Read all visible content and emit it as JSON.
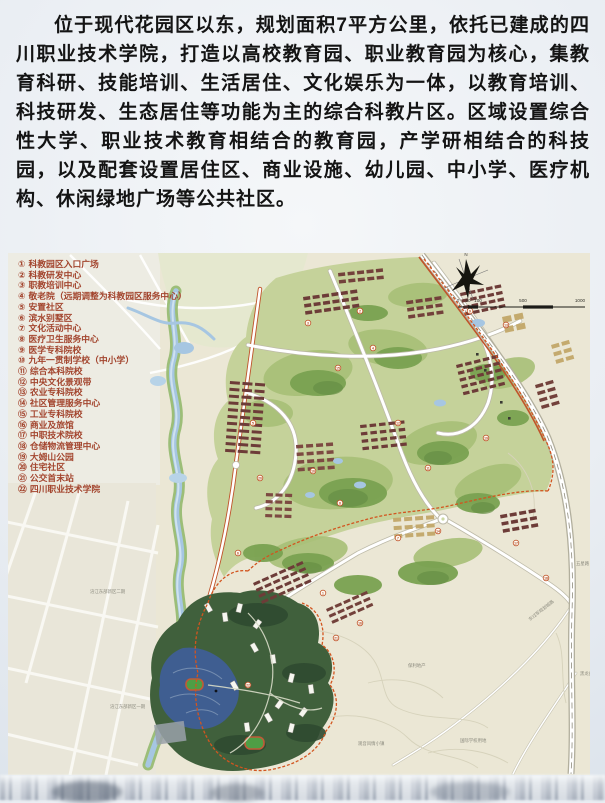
{
  "intro": {
    "text": "位于现代花园区以东，规划面积7平方公里，依托已建成的四川职业技术学院，打造以高校教育园、职业教育园为核心，集教育科研、技能培训、生活居住、文化娱乐为一体，以教育培训、科技研发、生态居住等功能为主的综合科教片区。区域设置综合性大学、职业技术教育相结合的教育园，产学研相结合的科技园，以及配套设置居住区、商业设施、幼儿园、中小学、医疗机构、休闲绿地广场等公共社区。"
  },
  "legend": {
    "items": [
      {
        "num": "①",
        "label": "科教园区入口广场"
      },
      {
        "num": "②",
        "label": "科教研发中心"
      },
      {
        "num": "③",
        "label": "职教培训中心"
      },
      {
        "num": "④",
        "label": "敬老院（远期调整为科教园区服务中心）"
      },
      {
        "num": "⑤",
        "label": "安置社区"
      },
      {
        "num": "⑥",
        "label": "滨水别墅区"
      },
      {
        "num": "⑦",
        "label": "文化活动中心"
      },
      {
        "num": "⑧",
        "label": "医疗卫生服务中心"
      },
      {
        "num": "⑨",
        "label": "医学专科院校"
      },
      {
        "num": "⑩",
        "label": "九年一贯制学校（中小学）"
      },
      {
        "num": "⑪",
        "label": "综合本科院校"
      },
      {
        "num": "⑫",
        "label": "中央文化景观带"
      },
      {
        "num": "⑬",
        "label": "农业专科院校"
      },
      {
        "num": "⑭",
        "label": "社区管理服务中心"
      },
      {
        "num": "⑮",
        "label": "工业专科院校"
      },
      {
        "num": "⑯",
        "label": "商业及旅馆"
      },
      {
        "num": "⑰",
        "label": "中职技术院校"
      },
      {
        "num": "⑱",
        "label": "仓储物流管理中心"
      },
      {
        "num": "⑲",
        "label": "大姆山公园"
      },
      {
        "num": "⑳",
        "label": "住宅社区"
      },
      {
        "num": "㉑",
        "label": "公交首末站"
      },
      {
        "num": "㉒",
        "label": "四川职业技术学院"
      }
    ]
  },
  "map": {
    "scale_ticks": [
      "0",
      "50",
      "100",
      "500",
      "1000"
    ],
    "labels": [
      {
        "text": "涪江东部新区二期"
      },
      {
        "text": "涪江东部新区一期"
      },
      {
        "text": "东过军规划城路"
      },
      {
        "text": "保利地产"
      },
      {
        "text": "观音风情小镇"
      },
      {
        "text": "国际学校用地"
      },
      {
        "text": "黑龙凼"
      },
      {
        "text": "五星路"
      }
    ]
  },
  "colors": {
    "legend_text": "#a3452e",
    "boundary": "#d2551f",
    "accent_road": "#c0532a",
    "map_base": "#ebe7d5"
  }
}
